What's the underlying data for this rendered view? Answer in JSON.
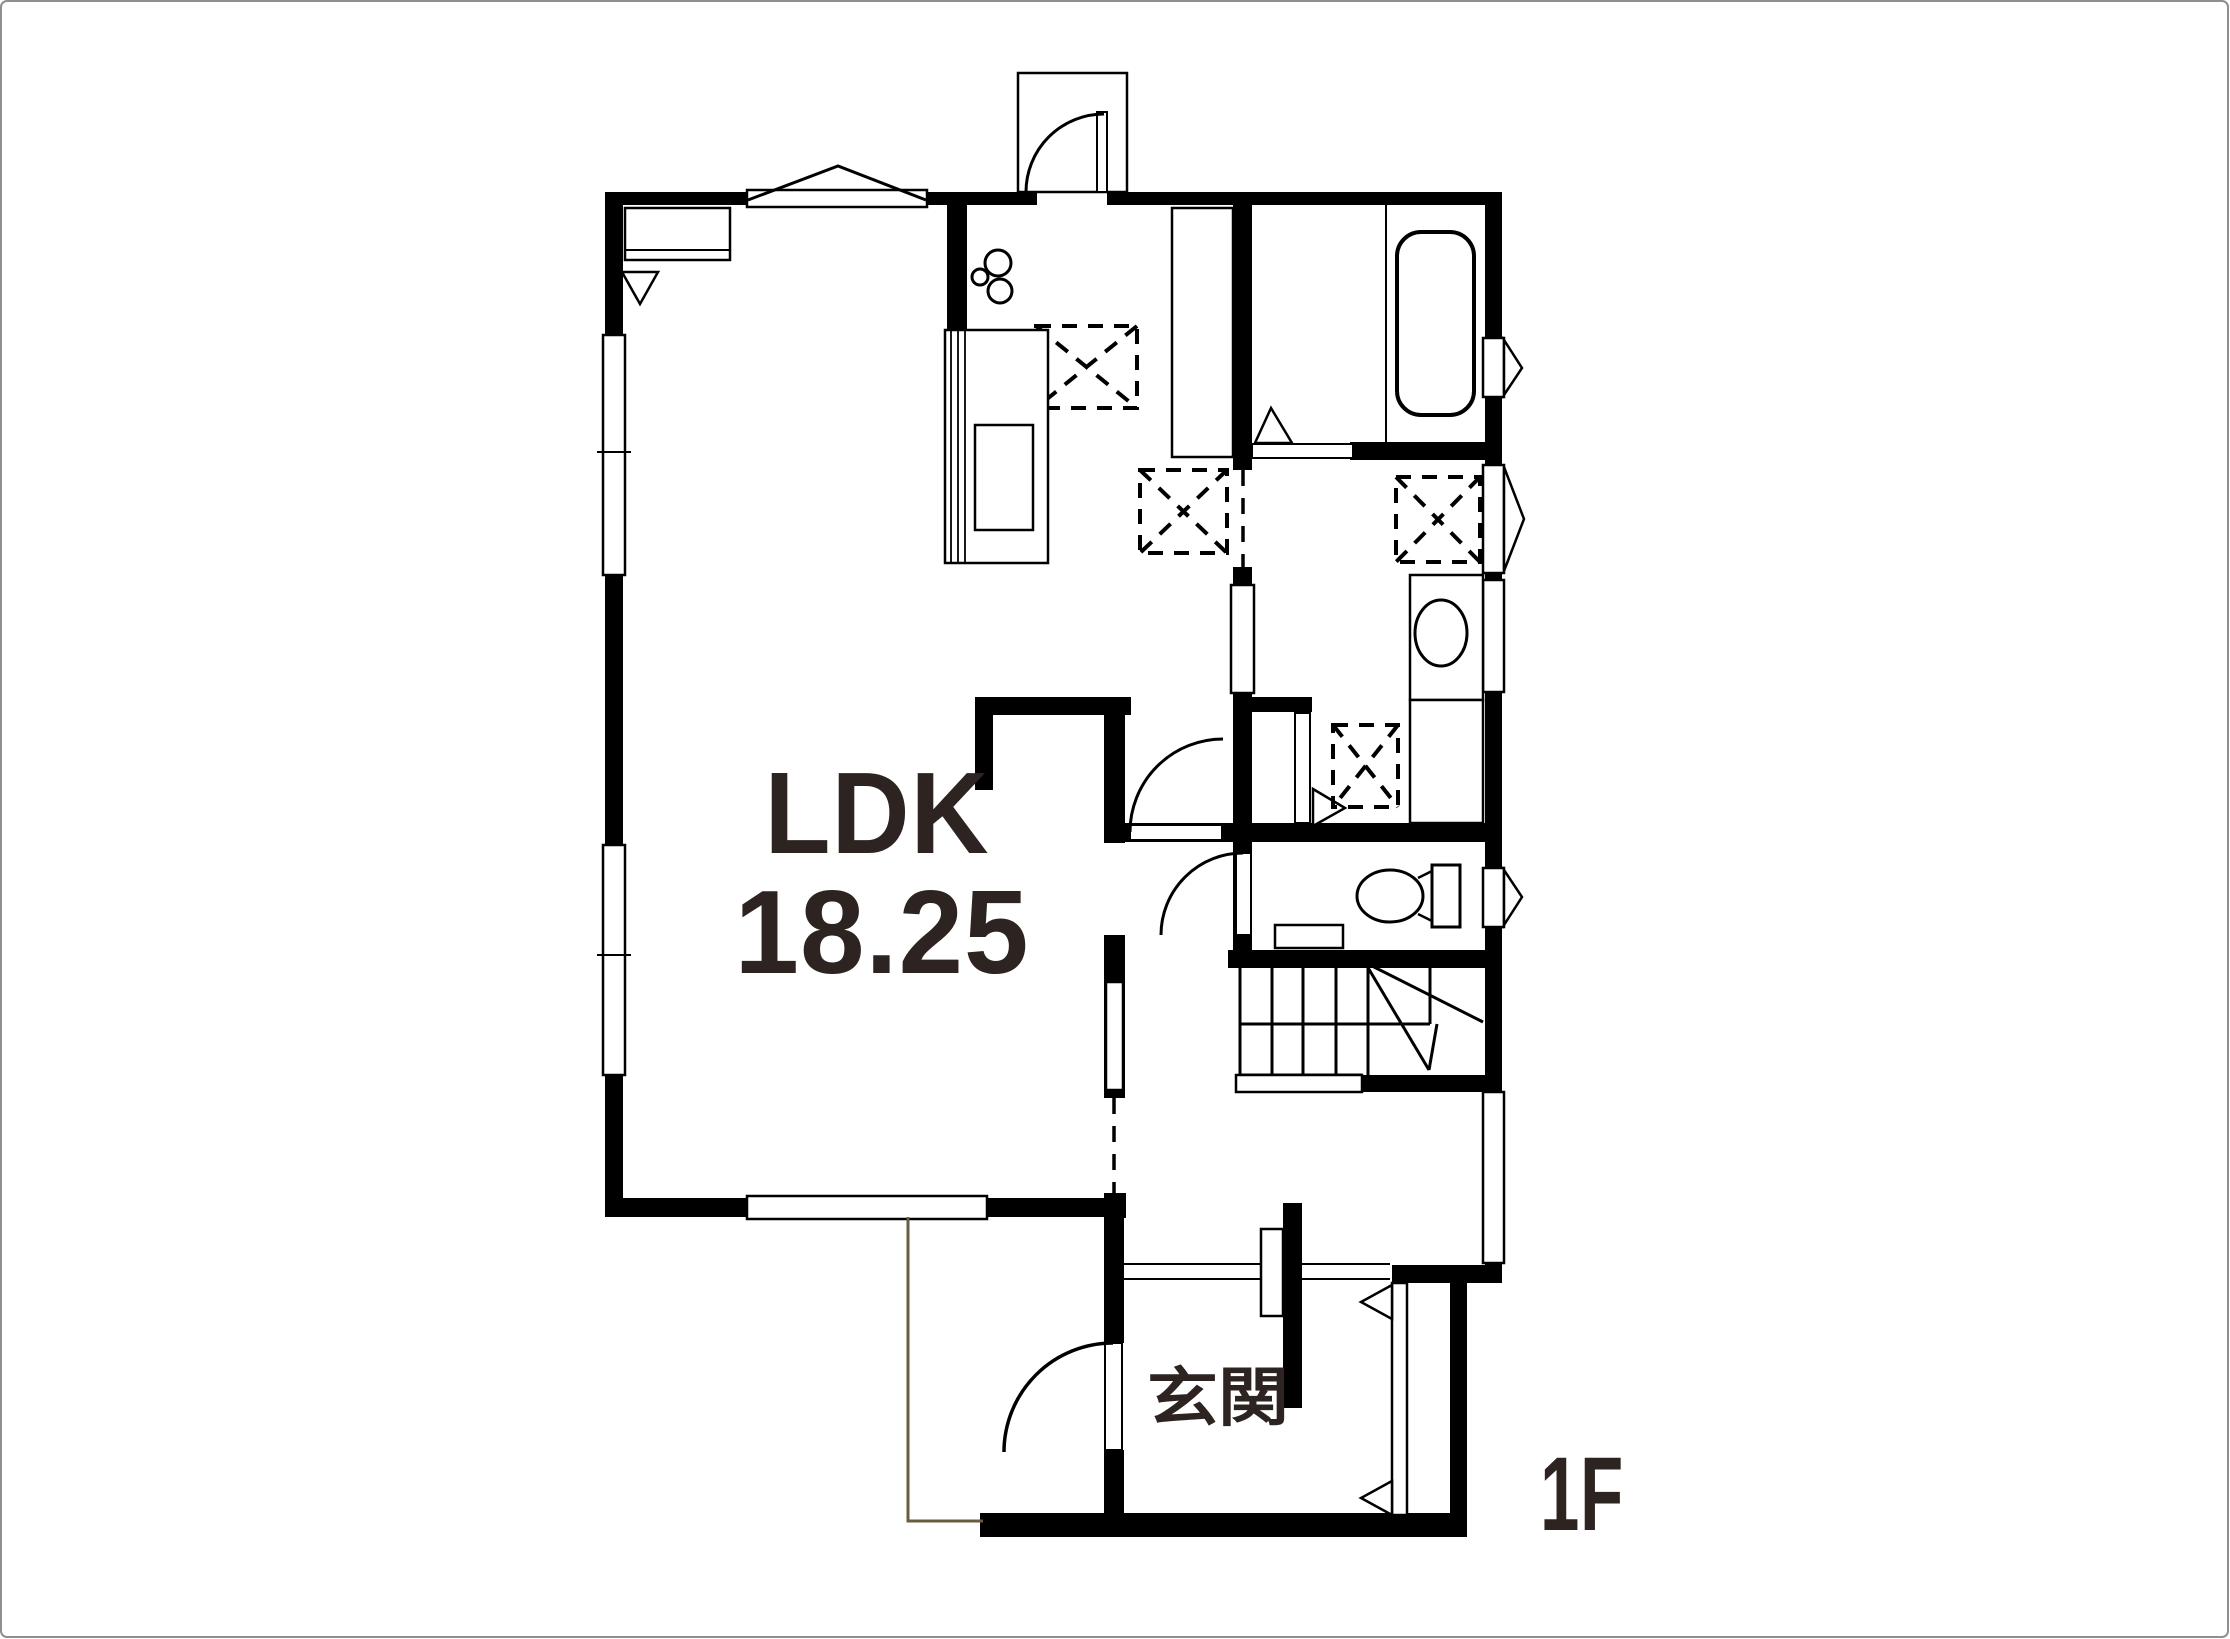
{
  "canvas": {
    "width": 2230,
    "height": 1639,
    "background": "#ffffff",
    "frame_border_color": "#8f8f8f"
  },
  "palette": {
    "wall_color": "#000000",
    "line_color": "#000000",
    "label_color": "#2d2421",
    "porch_line_color": "#6a5c40"
  },
  "labels": {
    "main_room_name": "LDK",
    "main_room_area": "18.25",
    "entrance_name": "玄関",
    "floor_indicator": "1F"
  }
}
